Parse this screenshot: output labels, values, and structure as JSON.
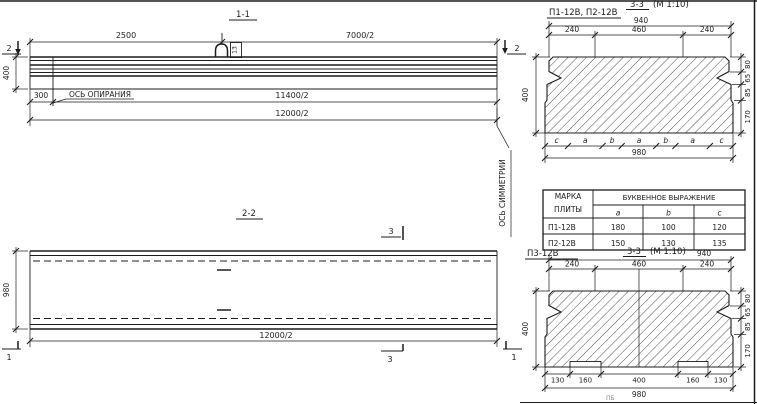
{
  "sheet": {
    "colors": {
      "ink": "#1c1c1c",
      "paper": "#ffffff"
    },
    "section_1_1": {
      "title": "1-1",
      "cut_left": "2",
      "cut_right": "2",
      "dim_2500": "2500",
      "dim_7000_2": "7000/2",
      "dim_400": "400",
      "dim_300": "300",
      "dim_11400_2": "11400/2",
      "dim_12000_2": "12000/2",
      "support_axis": "ОСЬ ОПИРАНИЯ",
      "symmetry_axis": "ОСЬ СИММЕТРИИ",
      "hook_mark": "13"
    },
    "section_2_2": {
      "title": "2-2",
      "dim_980": "980",
      "dim_12000_2": "12000/2",
      "cut_3_top": "3",
      "cut_3_bottom": "3",
      "cut_1_left": "1",
      "cut_1_right": "1"
    },
    "section_top_right": {
      "label": "П1-12В, П2-12В",
      "title": "3-3",
      "scale_note": "(М 1:10)",
      "dim_940": "940",
      "dim_240_left": "240",
      "dim_460": "460",
      "dim_240_right": "240",
      "dim_400": "400",
      "right_dims": [
        "80",
        "65",
        "85",
        "170"
      ],
      "letters": [
        "c",
        "a",
        "b",
        "a",
        "b",
        "a",
        "c"
      ],
      "dim_980": "980"
    },
    "table": {
      "header_col1_line1": "МАРКА",
      "header_col1_line2": "ПЛИТЫ",
      "header_expr": "БУКВЕННОЕ  ВЫРАЖЕНИЕ",
      "cols": [
        "a",
        "b",
        "c"
      ],
      "rows": [
        {
          "mark": "П1-12В",
          "a": "180",
          "b": "100",
          "c": "120"
        },
        {
          "mark": "П2-12В",
          "a": "150",
          "b": "130",
          "c": "135"
        }
      ]
    },
    "section_bottom_right": {
      "label": "П3-12В",
      "title": "3-3",
      "scale_note": "(М 1:10)",
      "dim_940": "940",
      "dim_240_left": "240",
      "dim_460": "460",
      "dim_240_right": "240",
      "dim_400": "400",
      "right_dims": [
        "80",
        "65",
        "85",
        "170"
      ],
      "bottom_dims": [
        "130",
        "160",
        "400",
        "160",
        "130"
      ],
      "dim_980": "980"
    },
    "footer_note": "ПБ"
  }
}
